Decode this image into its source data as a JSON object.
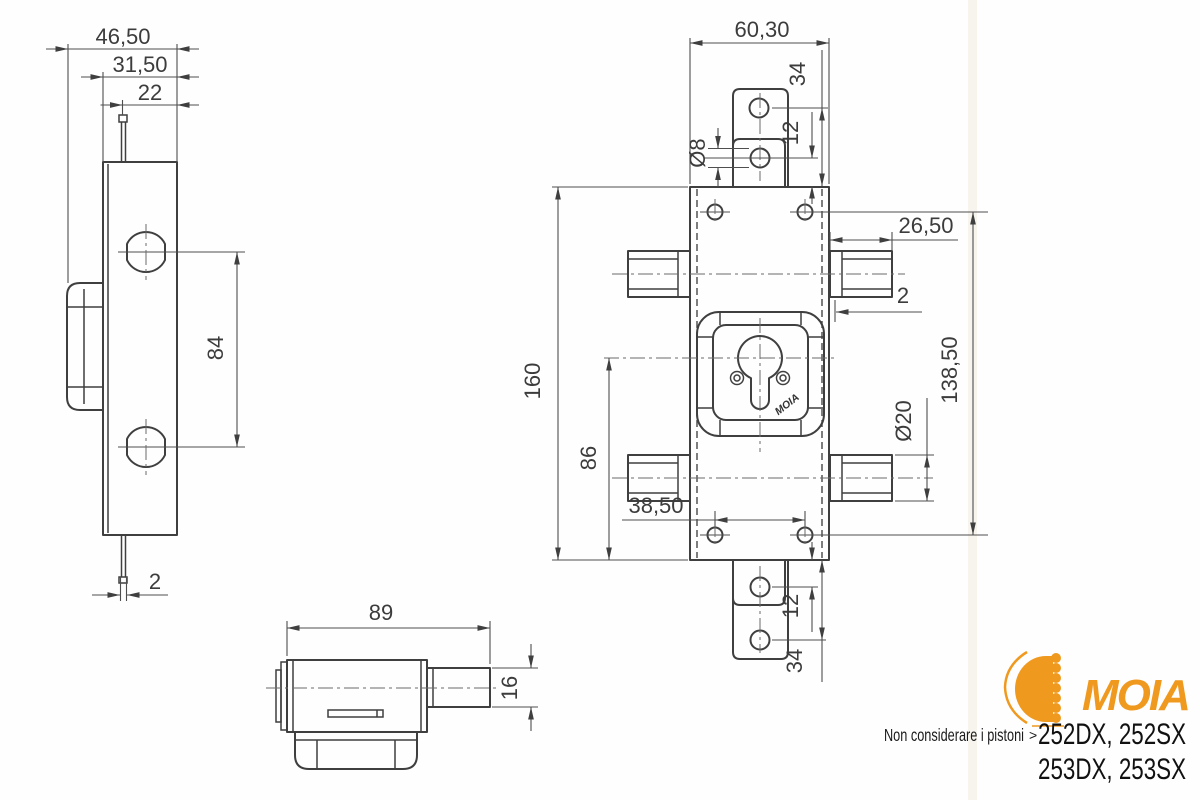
{
  "drawing_type": "technical-drawing-lock",
  "colors": {
    "line": "#3f3f3f",
    "accent_orange": "#F0991F",
    "text_dark": "#1a1a1a"
  },
  "dims": {
    "side": {
      "overall": "46,50",
      "body": "31,50",
      "pin_offset": "22",
      "hole_spacing": "84",
      "pin_width": "2"
    },
    "front": {
      "width": "60,30",
      "tab_edge_top": "34",
      "tab_gap_top": "12",
      "tab_hole_dia": "Ø8",
      "bolt_length": "26,50",
      "lip": "2",
      "holes_v": "138,50",
      "bolt_dia": "Ø20",
      "height": "160",
      "cyl_to_bottom": "86",
      "holes_h": "38,50",
      "tab_gap_bottom": "12",
      "tab_edge_bottom": "34"
    },
    "bottom": {
      "overall": "89",
      "bolt_height": "16"
    }
  },
  "stamp": "MOIA",
  "brand": {
    "name": "MOIA"
  },
  "note": {
    "text": "Non considerare i pistoni",
    "arrow": "˃",
    "models1": "252DX, 252SX",
    "models2": "253DX, 253SX"
  }
}
